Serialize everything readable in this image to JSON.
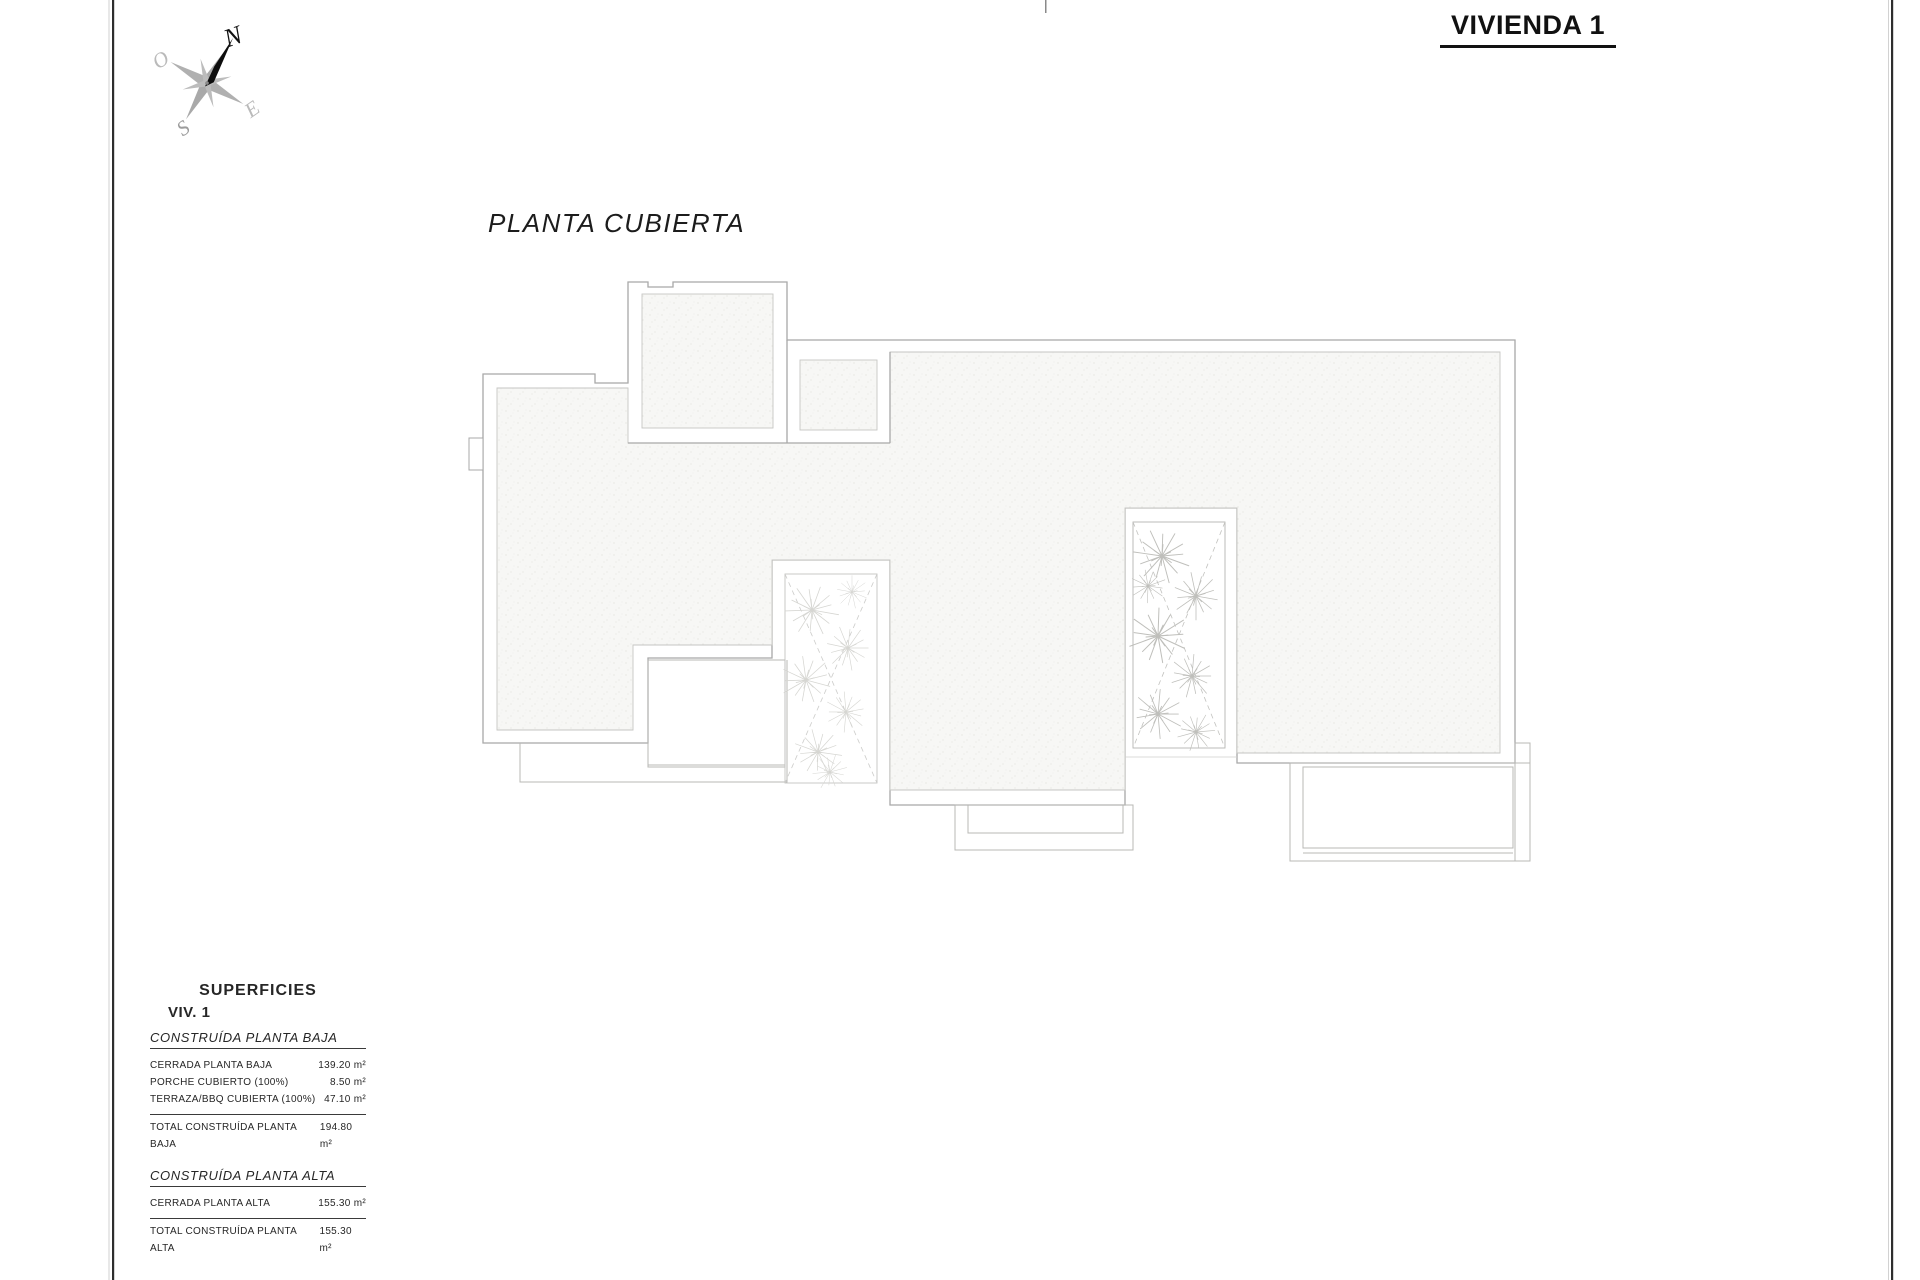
{
  "header": {
    "title": "VIVIENDA 1"
  },
  "plan": {
    "label": "PLANTA CUBIERTA"
  },
  "compass": {
    "north": "N",
    "south": "S",
    "east": "E",
    "west": "O"
  },
  "colors": {
    "drawing_line": "#a8a8a8",
    "page_border_dark": "#2e2e2e",
    "total_box_bg": "#ababab",
    "ink": "#111111"
  },
  "superficies": {
    "heading": "SUPERFICIES",
    "subheading": "VIV. 1",
    "sections": [
      {
        "title": "CONSTRUÍDA PLANTA BAJA",
        "rows": [
          {
            "label": "CERRADA PLANTA BAJA",
            "value": "139.20 m²"
          },
          {
            "label": "PORCHE CUBIERTO (100%)",
            "value": "8.50 m²"
          },
          {
            "label": "TERRAZA/BBQ CUBIERTA (100%)",
            "value": "47.10 m²"
          }
        ],
        "total": {
          "label": "TOTAL CONSTRUÍDA PLANTA BAJA",
          "value": "194.80 m²"
        }
      },
      {
        "title": "CONSTRUÍDA PLANTA ALTA",
        "rows": [
          {
            "label": "CERRADA PLANTA ALTA",
            "value": "155.30 m²"
          }
        ],
        "total": {
          "label": "TOTAL CONSTRUÍDA PLANTA ALTA",
          "value": "155.30 m²"
        }
      }
    ],
    "grand_total": {
      "label": "TOTAL CONSTRUÍDA VIVIENDA 1",
      "value": "350.10 m²"
    }
  }
}
